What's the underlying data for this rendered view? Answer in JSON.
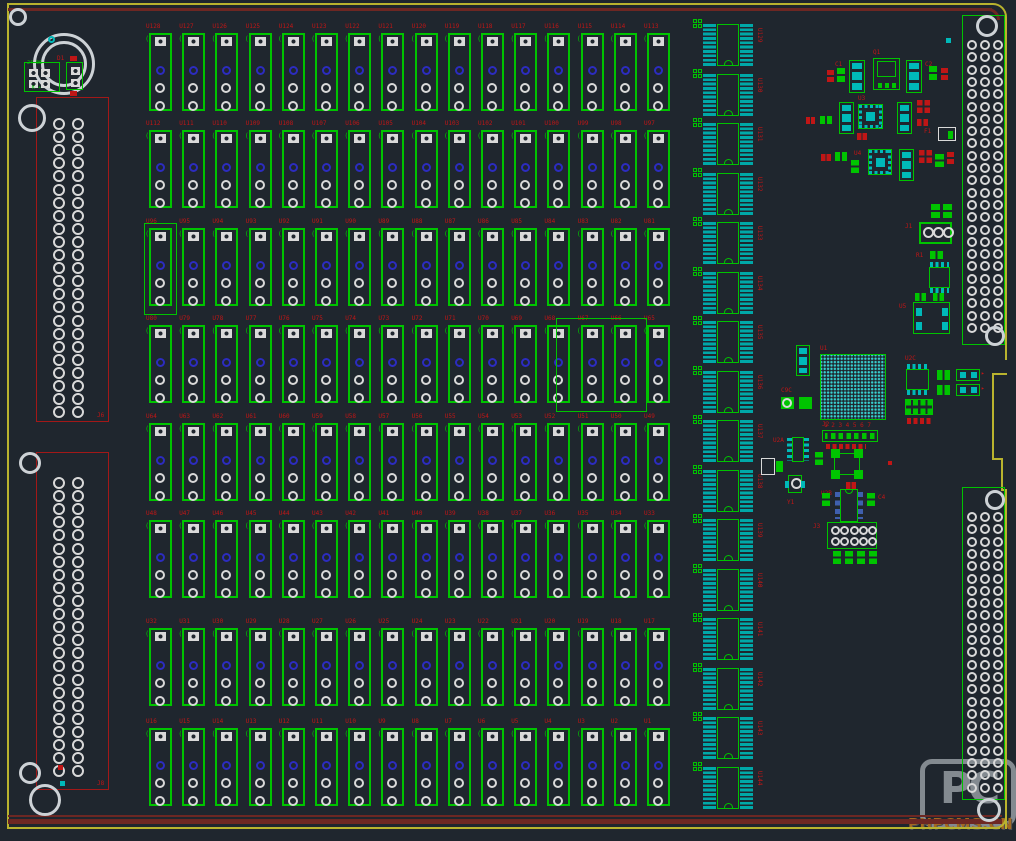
{
  "app": {
    "kind": "pcb-layout-editor-view"
  },
  "watermark": {
    "logo": "PC",
    "text": "PHPCMS.CN"
  },
  "colors": {
    "bg": "#1f262e",
    "green": "#00c400",
    "cyan": "#00b9b9",
    "padWhite": "#d9d9d9",
    "blue": "#2c2cc0",
    "red": "#c01616",
    "darkred": "#6d2723",
    "yellow": "#b9b32e",
    "dipPad": "#00a8a8",
    "bgaDot": "#39d3d3",
    "dip8Pad": "#3f5fae",
    "connRed": "#a21818",
    "wmGrey": "#9aa0a6",
    "wmOrange": "#c07820"
  },
  "board": {
    "width": 1016,
    "height": 841,
    "lines": [
      {
        "x": 7,
        "y": 3,
        "w": 982,
        "h": 2,
        "c": "yellow"
      },
      {
        "x": 7,
        "y": 3,
        "w": 2,
        "h": 826,
        "c": "yellow"
      },
      {
        "x": 7,
        "y": 827,
        "w": 993,
        "h": 2,
        "c": "yellow"
      },
      {
        "x": 1005,
        "y": 18,
        "w": 2,
        "h": 342,
        "c": "yellow"
      },
      {
        "x": 992,
        "y": 373,
        "w": 15,
        "h": 2,
        "c": "yellow"
      },
      {
        "x": 992,
        "y": 373,
        "w": 2,
        "h": 87,
        "c": "yellow"
      },
      {
        "x": 992,
        "y": 458,
        "w": 11,
        "h": 2,
        "c": "yellow"
      },
      {
        "x": 1001,
        "y": 458,
        "w": 2,
        "h": 33,
        "c": "yellow"
      },
      {
        "x": 1001,
        "y": 489,
        "w": 6,
        "h": 2,
        "c": "yellow"
      },
      {
        "x": 1005,
        "y": 489,
        "w": 2,
        "h": 340,
        "c": "yellow"
      },
      {
        "x": 8,
        "y": 8,
        "w": 984,
        "h": 3,
        "c": "darkred"
      },
      {
        "x": 8,
        "y": 815,
        "w": 994,
        "h": 2,
        "c": "darkred"
      },
      {
        "x": 8,
        "y": 819,
        "w": 994,
        "h": 5,
        "c": "darkred"
      }
    ],
    "arcs": [
      {
        "x": 986,
        "y": 3,
        "w": 21,
        "h": 17,
        "c": "yellow",
        "corner": "tr",
        "t": 2
      },
      {
        "x": 983,
        "y": 8,
        "w": 17,
        "h": 12,
        "c": "darkred",
        "corner": "tr",
        "t": 3
      },
      {
        "x": 993,
        "y": 813,
        "w": 14,
        "h": 16,
        "c": "yellow",
        "corner": "br",
        "t": 2
      }
    ]
  },
  "mount_holes": [
    {
      "x": 18,
      "y": 17,
      "r": 9
    },
    {
      "x": 64,
      "y": 64,
      "r": 31,
      "inner": 23
    },
    {
      "x": 32,
      "y": 118,
      "r": 14
    },
    {
      "x": 30,
      "y": 463,
      "r": 11
    },
    {
      "x": 30,
      "y": 773,
      "r": 11
    },
    {
      "x": 45,
      "y": 800,
      "r": 16
    },
    {
      "x": 987,
      "y": 26,
      "r": 11
    },
    {
      "x": 995,
      "y": 336,
      "r": 10
    },
    {
      "x": 995,
      "y": 500,
      "r": 10
    },
    {
      "x": 989,
      "y": 810,
      "r": 12
    }
  ],
  "left_connectors": [
    {
      "x": 36,
      "y": 97,
      "w": 73,
      "h": 325,
      "label": "J6",
      "pad_d": 12,
      "cols_x": [
        16,
        35
      ],
      "y0": 20,
      "pitch": 13.1,
      "rows": 23
    },
    {
      "x": 36,
      "y": 452,
      "w": 73,
      "h": 338,
      "label": "J8",
      "pad_d": 12,
      "cols_x": [
        16,
        35
      ],
      "y0": 24,
      "pitch": 13.1,
      "rows": 23
    }
  ],
  "right_connectors": [
    {
      "x": 962,
      "y": 15,
      "w": 43,
      "h": 330,
      "pad_d": 10,
      "cols_x": [
        4,
        17,
        30
      ],
      "y0": 24,
      "pitch": 12.3,
      "rows": 24
    },
    {
      "x": 962,
      "y": 487,
      "w": 43,
      "h": 313,
      "pad_d": 10,
      "cols_x": [
        4,
        17,
        30
      ],
      "y0": 24,
      "pitch": 12.3,
      "rows": 23
    }
  ],
  "relay_grid": {
    "x0": 149,
    "pitch": 33.2,
    "w": 23,
    "h": 78,
    "rows_y": [
      33,
      130,
      228,
      325,
      423,
      520,
      628,
      728
    ],
    "labels": [
      [
        "U128",
        "U127",
        "U126",
        "U125",
        "U124",
        "U123",
        "U122",
        "U121",
        "U120",
        "U119",
        "U118",
        "U117",
        "U116",
        "U115",
        "U114",
        "U113"
      ],
      [
        "U112",
        "U111",
        "U110",
        "U109",
        "U108",
        "U107",
        "U106",
        "U105",
        "U104",
        "U103",
        "U102",
        "U101",
        "U100",
        "U99",
        "U98",
        "U97"
      ],
      [
        "U96",
        "U95",
        "U94",
        "U93",
        "U92",
        "U91",
        "U90",
        "U89",
        "U88",
        "U87",
        "U86",
        "U85",
        "U84",
        "U83",
        "U82",
        "U81"
      ],
      [
        "U80",
        "U79",
        "U78",
        "U77",
        "U76",
        "U75",
        "U74",
        "U73",
        "U72",
        "U71",
        "U70",
        "U69",
        "U68",
        "U67",
        "U66",
        "U65"
      ],
      [
        "U64",
        "U63",
        "U62",
        "U61",
        "U60",
        "U59",
        "U58",
        "U57",
        "U56",
        "U55",
        "U54",
        "U53",
        "U52",
        "U51",
        "U50",
        "U49"
      ],
      [
        "U48",
        "U47",
        "U46",
        "U45",
        "U44",
        "U43",
        "U42",
        "U41",
        "U40",
        "U39",
        "U38",
        "U37",
        "U36",
        "U35",
        "U34",
        "U33"
      ],
      [
        "U32",
        "U31",
        "U30",
        "U29",
        "U28",
        "U27",
        "U26",
        "U25",
        "U24",
        "U23",
        "U22",
        "U21",
        "U20",
        "U19",
        "U18",
        "U17"
      ],
      [
        "U16",
        "U15",
        "U14",
        "U13",
        "U12",
        "U11",
        "U10",
        "U9",
        "U8",
        "U7",
        "U6",
        "U5",
        "U4",
        "U3",
        "U2",
        "U1"
      ]
    ]
  },
  "selection_outlines": [
    {
      "x": 144,
      "y": 223,
      "w": 33,
      "h": 92
    },
    {
      "x": 556,
      "y": 318,
      "w": 91,
      "h": 94
    }
  ],
  "dip_column": {
    "x": 700,
    "y0": 24,
    "pitch": 49.5,
    "h": 42,
    "count": 16,
    "labels": [
      "U129",
      "U130",
      "U131",
      "U132",
      "U133",
      "U134",
      "U135",
      "U136",
      "U137",
      "U138",
      "U139",
      "U140",
      "U141",
      "U142",
      "U143",
      "U144"
    ]
  },
  "topleft_group": {
    "box": {
      "x": 24,
      "y": 62,
      "w": 36,
      "h": 30,
      "text_top": "24-06",
      "text_bottom": "K +"
    },
    "comp": {
      "x": 66,
      "y": 62,
      "w": 17,
      "h": 28,
      "label": "D1"
    },
    "ring": {
      "x": 48,
      "y": 36,
      "d": 7
    }
  },
  "smd": [
    {
      "t": "v3",
      "x": 849,
      "y": 60,
      "w": 16,
      "h": 33,
      "label": "C1",
      "lp": "left"
    },
    {
      "t": "dpak",
      "x": 873,
      "y": 58,
      "w": 27,
      "h": 32,
      "label": "Q1",
      "lp": "top"
    },
    {
      "t": "v3",
      "x": 906,
      "y": 60,
      "w": 16,
      "h": 33,
      "label": "C2",
      "lp": "right"
    },
    {
      "t": "g2v",
      "x": 837,
      "y": 68,
      "w": 8,
      "h": 14
    },
    {
      "t": "r2v",
      "x": 827,
      "y": 70,
      "w": 7,
      "h": 12
    },
    {
      "t": "g2v",
      "x": 929,
      "y": 66,
      "w": 8,
      "h": 14
    },
    {
      "t": "r2v",
      "x": 941,
      "y": 68,
      "w": 7,
      "h": 12
    },
    {
      "t": "v3",
      "x": 839,
      "y": 102,
      "w": 15,
      "h": 32
    },
    {
      "t": "qfn",
      "x": 858,
      "y": 104,
      "w": 25,
      "h": 25,
      "label": "U3",
      "lp": "top"
    },
    {
      "t": "v3",
      "x": 897,
      "y": 102,
      "w": 15,
      "h": 32
    },
    {
      "t": "r4",
      "x": 917,
      "y": 100,
      "w": 13,
      "h": 13
    },
    {
      "t": "g2h",
      "x": 820,
      "y": 116,
      "w": 12,
      "h": 8
    },
    {
      "t": "r2h",
      "x": 806,
      "y": 117,
      "w": 9,
      "h": 7
    },
    {
      "t": "r2h",
      "x": 917,
      "y": 119,
      "w": 11,
      "h": 7
    },
    {
      "t": "r2h",
      "x": 857,
      "y": 133,
      "w": 10,
      "h": 7
    },
    {
      "t": "qfn",
      "x": 868,
      "y": 149,
      "w": 24,
      "h": 26,
      "label": "U4",
      "lp": "left"
    },
    {
      "t": "g2h",
      "x": 835,
      "y": 152,
      "w": 12,
      "h": 9
    },
    {
      "t": "r2h",
      "x": 821,
      "y": 154,
      "w": 10,
      "h": 7
    },
    {
      "t": "g2v",
      "x": 851,
      "y": 160,
      "w": 8,
      "h": 13
    },
    {
      "t": "v3",
      "x": 899,
      "y": 149,
      "w": 15,
      "h": 32
    },
    {
      "t": "r4",
      "x": 919,
      "y": 150,
      "w": 13,
      "h": 13
    },
    {
      "t": "g2v",
      "x": 935,
      "y": 154,
      "w": 9,
      "h": 13
    },
    {
      "t": "r2v",
      "x": 947,
      "y": 152,
      "w": 7,
      "h": 12
    },
    {
      "t": "wbox",
      "x": 938,
      "y": 127,
      "w": 18,
      "h": 14,
      "label": "F1",
      "lp": "left"
    },
    {
      "t": "dotc",
      "x": 946,
      "y": 38,
      "w": 5,
      "h": 5
    },
    {
      "t": "g2v",
      "x": 931,
      "y": 204,
      "w": 9,
      "h": 14
    },
    {
      "t": "g2v",
      "x": 943,
      "y": 204,
      "w": 9,
      "h": 14
    },
    {
      "t": "term3",
      "x": 919,
      "y": 222,
      "w": 33,
      "h": 22,
      "label": "J1",
      "lp": "left"
    },
    {
      "t": "g2h",
      "x": 930,
      "y": 251,
      "w": 13,
      "h": 8,
      "label": "R1",
      "lp": "left"
    },
    {
      "t": "soic8h",
      "x": 928,
      "y": 262,
      "w": 23,
      "h": 31
    },
    {
      "t": "g2h",
      "x": 915,
      "y": 293,
      "w": 11,
      "h": 8
    },
    {
      "t": "g2h",
      "x": 933,
      "y": 293,
      "w": 11,
      "h": 8
    },
    {
      "t": "icbig",
      "x": 913,
      "y": 302,
      "w": 37,
      "h": 32,
      "label": "U5",
      "lp": "left"
    },
    {
      "t": "v3",
      "x": 796,
      "y": 345,
      "w": 14,
      "h": 31
    },
    {
      "t": "bga",
      "x": 820,
      "y": 354,
      "w": 66,
      "h": 66,
      "label": "U1",
      "lp": "top"
    },
    {
      "t": "pad2big",
      "x": 781,
      "y": 396,
      "w": 31,
      "h": 15,
      "label": "C9C",
      "lp": "top"
    },
    {
      "t": "soic8h",
      "x": 905,
      "y": 364,
      "w": 25,
      "h": 31,
      "label": "U2C",
      "lp": "top"
    },
    {
      "t": "g2h",
      "x": 937,
      "y": 370,
      "w": 13,
      "h": 10
    },
    {
      "t": "g2h",
      "x": 937,
      "y": 385,
      "w": 13,
      "h": 10
    },
    {
      "t": "arrow2",
      "x": 956,
      "y": 369,
      "w": 24,
      "h": 12
    },
    {
      "t": "arrow2",
      "x": 956,
      "y": 384,
      "w": 24,
      "h": 12
    },
    {
      "t": "hdr4x2",
      "x": 905,
      "y": 399,
      "w": 28,
      "h": 16
    },
    {
      "t": "r4row",
      "x": 907,
      "y": 418,
      "w": 24,
      "h": 6
    },
    {
      "t": "hdrrow",
      "x": 822,
      "y": 430,
      "w": 56,
      "h": 12,
      "label": "J2",
      "lp": "top"
    },
    {
      "t": "soic8v",
      "x": 787,
      "y": 436,
      "w": 22,
      "h": 27,
      "label": "U2A",
      "lp": "left"
    },
    {
      "t": "cross4",
      "x": 831,
      "y": 449,
      "w": 32,
      "h": 30
    },
    {
      "t": "wpad2",
      "x": 761,
      "y": 458,
      "w": 22,
      "h": 17
    },
    {
      "t": "g2v",
      "x": 815,
      "y": 452,
      "w": 8,
      "h": 13
    },
    {
      "t": "crystal",
      "x": 785,
      "y": 475,
      "w": 20,
      "h": 22,
      "label": "Y1",
      "lp": "below"
    },
    {
      "t": "r2h",
      "x": 846,
      "y": 482,
      "w": 10,
      "h": 7
    },
    {
      "t": "dip8",
      "x": 835,
      "y": 489,
      "w": 28,
      "h": 33,
      "label": "U2B",
      "lp": "left"
    },
    {
      "t": "g2v",
      "x": 822,
      "y": 493,
      "w": 8,
      "h": 13
    },
    {
      "t": "g2v",
      "x": 867,
      "y": 493,
      "w": 8,
      "h": 13,
      "label": "C4",
      "lp": "right"
    },
    {
      "t": "hdr2x5",
      "x": 827,
      "y": 522,
      "w": 50,
      "h": 27,
      "label": "J3",
      "lp": "left"
    },
    {
      "t": "g2v",
      "x": 833,
      "y": 551,
      "w": 8,
      "h": 13
    },
    {
      "t": "g2v",
      "x": 845,
      "y": 551,
      "w": 8,
      "h": 13
    },
    {
      "t": "g2v",
      "x": 857,
      "y": 551,
      "w": 8,
      "h": 13
    },
    {
      "t": "g2v",
      "x": 869,
      "y": 551,
      "w": 8,
      "h": 13
    },
    {
      "t": "dotr",
      "x": 58,
      "y": 765,
      "w": 5,
      "h": 5
    },
    {
      "t": "dotc",
      "x": 60,
      "y": 781,
      "w": 5,
      "h": 5
    },
    {
      "t": "dotr",
      "x": 888,
      "y": 461,
      "w": 4,
      "h": 4
    }
  ]
}
